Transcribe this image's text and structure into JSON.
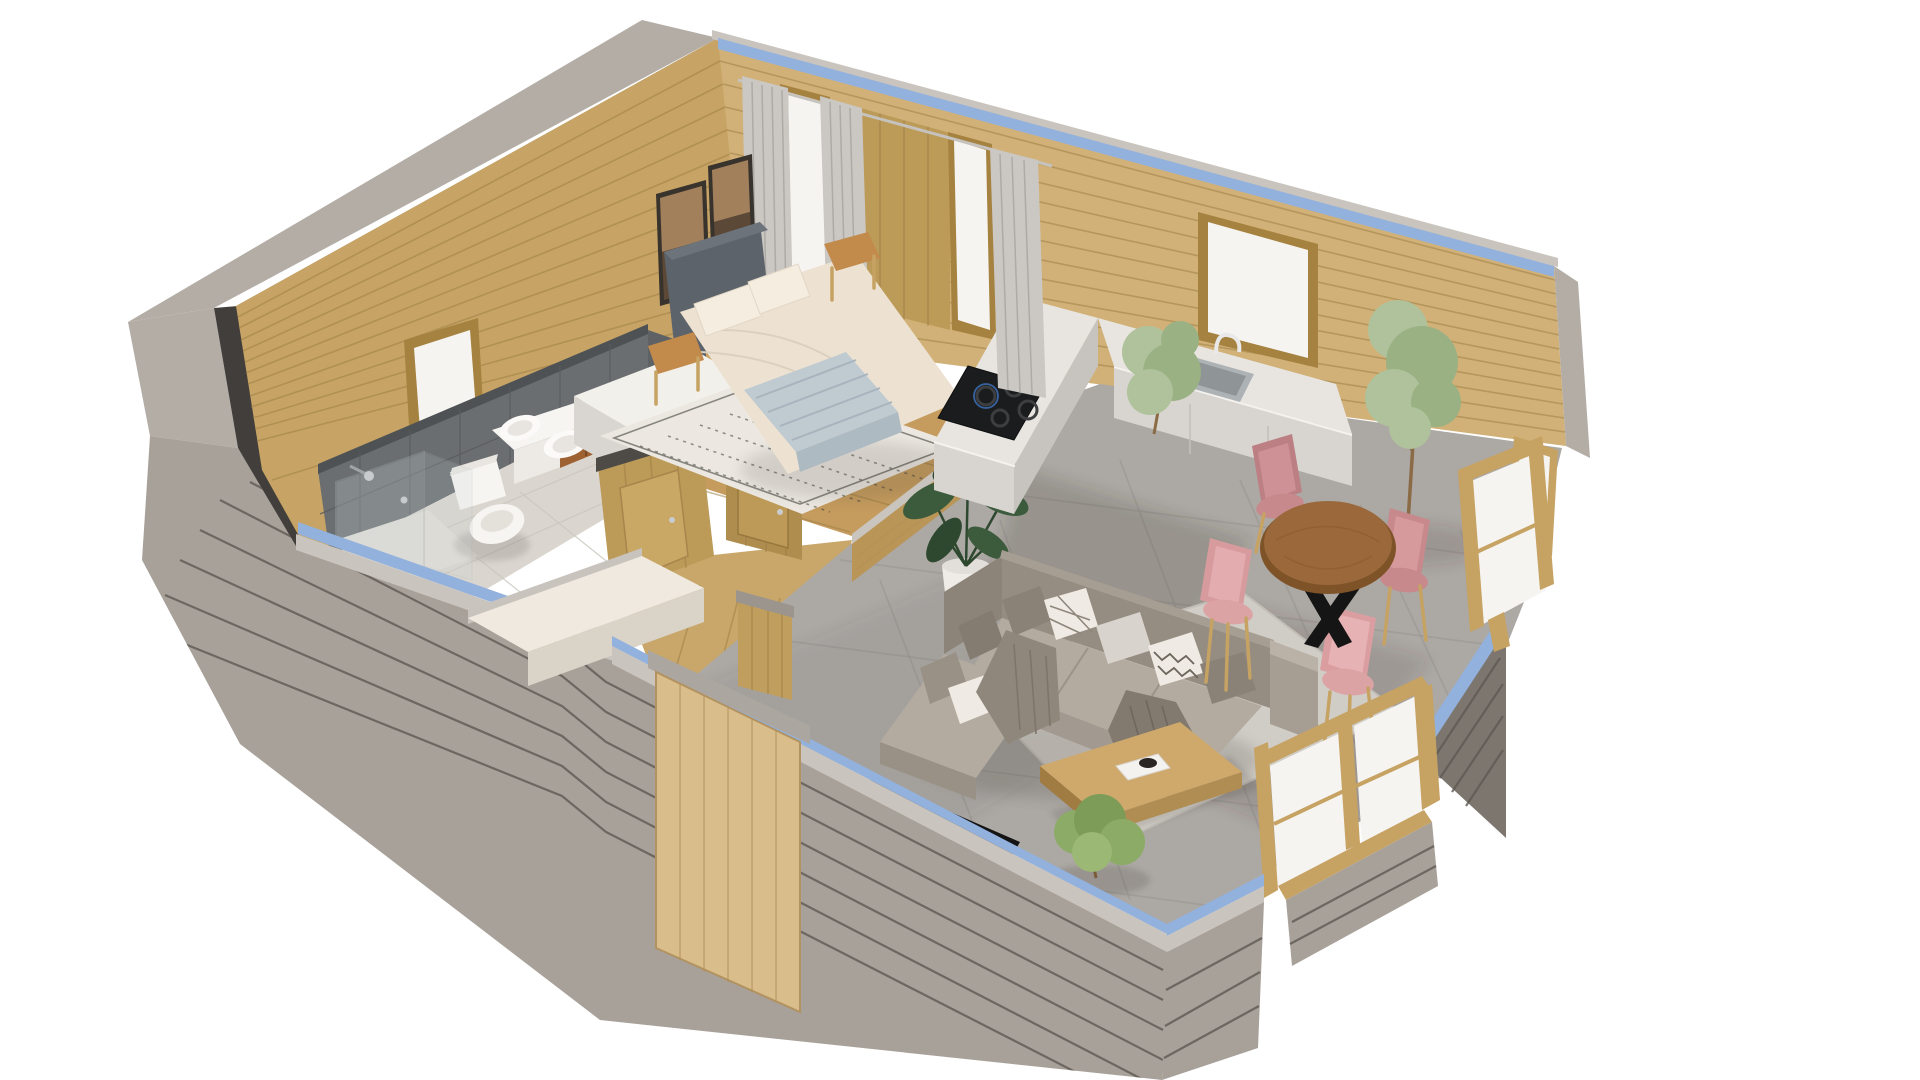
{
  "scene": {
    "type": "3d-floorplan-render",
    "description": "Isometric 3D cutaway floor plan render of a small wooden cabin on a white background, with bedroom, bathroom, hallway, kitchen, living room, dining area and front porch",
    "view": "dollhouse cutaway, low exterior walls cut open, tall timber back walls"
  },
  "colors": {
    "bg": "#FFFFFF",
    "woodWall": "#C7A465",
    "woodWallLight": "#D1B177",
    "panelWood": "#BC9A58",
    "plankLine": "#9A7C44",
    "capGray": "#C9C4BD",
    "capGraySide": "#B3ADA6",
    "edgeDark": "#413E3B",
    "blueTrim": "#93B1DD",
    "grayWall": "#A8A199",
    "grayLine": "#5E5852",
    "darkPanel": "#7C766F",
    "tileDark": "#6B6E70",
    "tileDarkLine": "#595C5E",
    "tileFloor": "#DAD6CF",
    "grout": "#9B9793",
    "woodFloor": "#C59C5E",
    "woodFloorLight": "#C9A76A",
    "grayFloor": "#ACA8A4",
    "rugLiving": "#D0CCC6",
    "rugBed": "#ECE8E1",
    "rugPattern": "#45423E",
    "counterTop": "#E8E5E1",
    "counterFace": "#D8D5D0",
    "counterInner": "#C7C4BF",
    "stoveBlack": "#1B1C1D",
    "sinkSteel": "#ADB3B5",
    "white": "#F6F4F1",
    "toiletWhite": "#F7F5F2",
    "sofaBack": "#968D82",
    "sofaSeat": "#B4ABA0",
    "sofaLight": "#BBB2A7",
    "pillowGray": "#8B8277",
    "pillowWhite": "#EFEBE4",
    "throwDark": "#837A6F",
    "oak": "#CFA96C",
    "oakDark": "#B08D52",
    "walnut": "#9A683A",
    "walnutDark": "#7D5327",
    "black": "#151515",
    "pinkChair": "#C8898C",
    "pinkChairLight": "#DCA3A5",
    "legWood": "#C6A263",
    "greenDark": "#3C5A3C",
    "greenDarker": "#2E482F",
    "greenPale": "#AFC29B",
    "greenPale2": "#9AB184",
    "shrubGreen": "#8CAB66",
    "potWhite": "#EFECE8",
    "bedding": "#EDE2D1",
    "pillowCream": "#F5EDE0",
    "headboard": "#5D636A",
    "blanket": "#BFCAD1",
    "blanketLine": "#A7B4BD",
    "doorWood": "#D9BE8C",
    "curtain": "#CBC7C3",
    "curtainShade": "#ABA7A3",
    "glassTint": "#C7D2D6",
    "artLight": "#A3805C",
    "artDark": "#5C4836",
    "frameDark": "#39332D",
    "nightstand": "#C28A4B",
    "shadow": "#3E3933"
  },
  "rooms": {
    "bedroom": {
      "label": "Bedroom",
      "items": [
        "double-bed",
        "gray-headboard",
        "cream-bedding",
        "blue-striped-throw",
        "bed-pillows",
        "patterned-area-rug",
        "nightstand",
        "bedside-stool",
        "framed-wall-art",
        "framed-wall-art-2",
        "small-window",
        "curtained-doorways"
      ]
    },
    "bathroom": {
      "label": "Bathroom",
      "items": [
        "walk-in-shower",
        "glass-shower-screen",
        "toilet",
        "floating-vanity",
        "double-vessel-sinks",
        "dark-tiled-walls",
        "small-window"
      ]
    },
    "hallway": {
      "label": "Hallway",
      "items": [
        "interior-door",
        "interior-door-2",
        "wardrobe-unit",
        "front-door",
        "porch-platform"
      ]
    },
    "kitchen": {
      "label": "Kitchen",
      "items": [
        "l-shaped-counter",
        "gas-cooktop",
        "kitchen-sink",
        "faucet",
        "window",
        "potted-plant"
      ]
    },
    "living_room": {
      "label": "Living room",
      "items": [
        "corner-sofa",
        "throw-pillows",
        "draped-throw",
        "coffee-table",
        "book",
        "area-rug",
        "tv-strip",
        "potted-shrub",
        "monstera-plant"
      ]
    },
    "dining_area": {
      "label": "Dining area",
      "items": [
        "round-dining-table",
        "dining-chair-north",
        "dining-chair-west",
        "dining-chair-south",
        "dining-chair-east",
        "tall-potted-tree",
        "glazed-patio-doors",
        "corner-glazing"
      ]
    }
  }
}
